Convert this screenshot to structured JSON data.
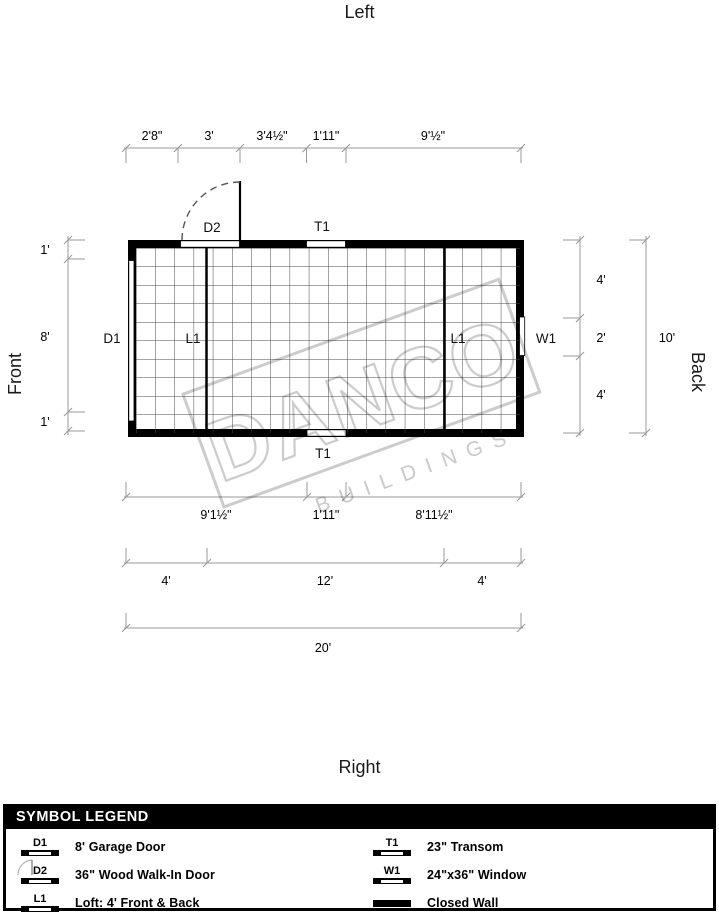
{
  "orientation_labels": {
    "top": "Left",
    "bottom": "Right",
    "left": "Front",
    "right": "Back"
  },
  "watermark": {
    "line1": "DANCO",
    "line2": "BUILDINGS"
  },
  "plan_labels": {
    "d1": "D1",
    "d2": "D2",
    "l1_left": "L1",
    "l1_right": "L1",
    "w1": "W1",
    "t1_top": "T1",
    "t1_bottom": "T1"
  },
  "dimensions": {
    "top": [
      "2'8\"",
      "3'",
      "3'4½\"",
      "1'11\"",
      "9'½\""
    ],
    "left": [
      "1'",
      "8'",
      "1'"
    ],
    "right_sections": [
      "4'",
      "2'",
      "4'"
    ],
    "right_total": "10'",
    "bottom_row1": [
      "9'1½\"",
      "1'11\"",
      "8'11½\""
    ],
    "bottom_row2": [
      "4'",
      "12'",
      "4'"
    ],
    "bottom_total": "20'"
  },
  "legend": {
    "title": "SYMBOL LEGEND",
    "items_left": [
      {
        "code": "D1",
        "label": "8' Garage Door"
      },
      {
        "code": "D2",
        "label": "36\" Wood Walk-In Door"
      },
      {
        "code": "L1",
        "label": "Loft: 4' Front & Back"
      }
    ],
    "items_right": [
      {
        "code": "T1",
        "label": "23\" Transom"
      },
      {
        "code": "W1",
        "label": "24\"x36\" Window"
      },
      {
        "code": "",
        "label": "Closed Wall"
      }
    ]
  },
  "colors": {
    "wall": "#000000",
    "dim_line": "#999999",
    "grid": "#4a4a4a",
    "watermark": "#cccccc"
  }
}
